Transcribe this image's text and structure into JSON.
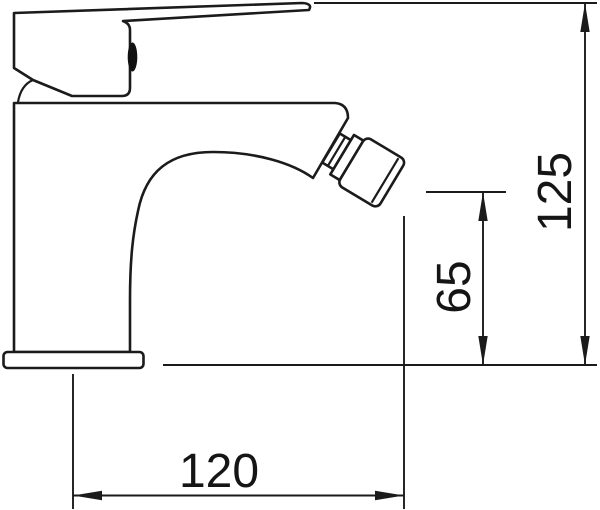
{
  "page": {
    "background": "#ffffff",
    "ink": "#1b1b1b"
  },
  "drawing": {
    "subject": "single-lever bidet mixer tap, side elevation",
    "dimensions": {
      "overall_height": "125",
      "outlet_height": "65",
      "overall_depth": "120"
    }
  }
}
